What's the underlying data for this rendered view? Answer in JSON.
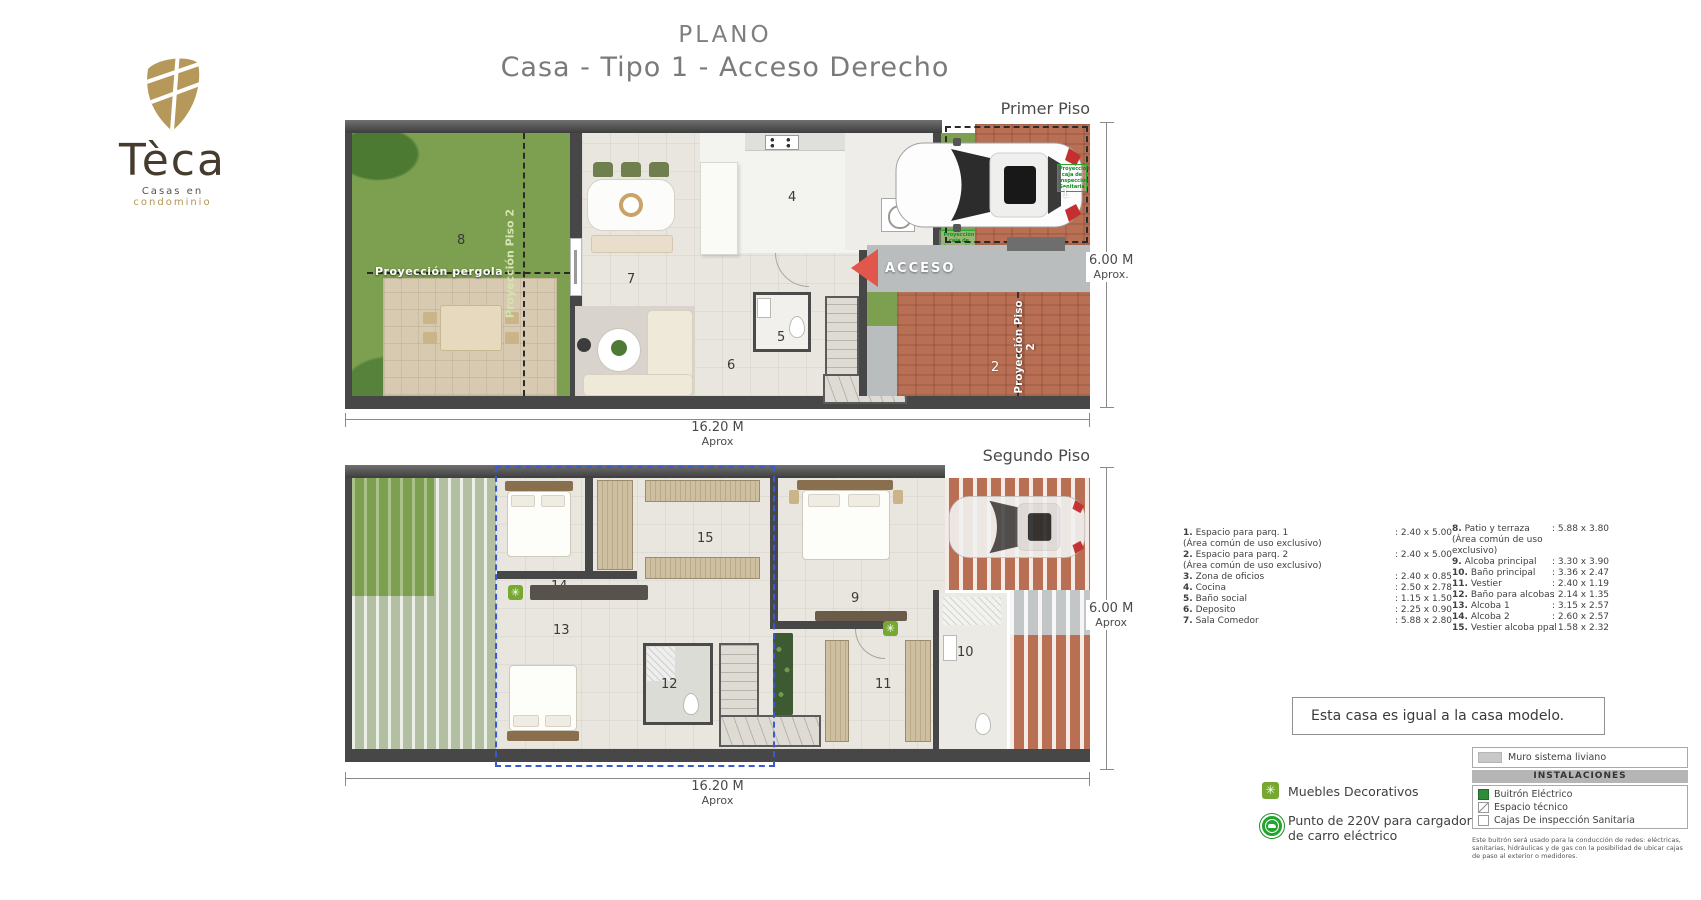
{
  "logo": {
    "brand": "Tèca",
    "tagline_a": "Casas en",
    "tagline_b": "condominio"
  },
  "title": {
    "line1": "PLANO",
    "line2": "Casa - Tipo 1 - Acceso Derecho"
  },
  "icons": {
    "asterisk": "✳"
  },
  "floor1": {
    "label": "Primer Piso",
    "dim_width": "16.20 M",
    "dim_width_sub": "Aprox",
    "dim_height": "6.00 M",
    "dim_height_sub": "Aprox.",
    "acceso": "ACCESO",
    "proy_pergola": "Proyección pergola",
    "proy_piso2_left": "Proyección Piso 2",
    "proy_piso2_right": "Proyección Piso 2",
    "proy_caja": "Proyección caja de inspección Sanitaria",
    "n1": "1",
    "n2": "2",
    "n3": "3",
    "n4": "4",
    "n5": "5",
    "n6": "6",
    "n7": "7",
    "n8": "8"
  },
  "floor2": {
    "label": "Segundo Piso",
    "dim_width": "16.20 M",
    "dim_width_sub": "Aprox",
    "dim_height": "6.00 M",
    "dim_height_sub": "Aprox",
    "n9": "9",
    "n10": "10",
    "n11": "11",
    "n12": "12",
    "n13": "13",
    "n14": "14",
    "n15": "15"
  },
  "legend": {
    "col1": [
      {
        "num": "1.",
        "name": "Espacio para parq. 1",
        "sub": "(Área común de uso exclusivo)",
        "size": ": 2.40 x 5.00"
      },
      {
        "num": "2.",
        "name": "Espacio para parq. 2",
        "sub": "(Área común de uso exclusivo)",
        "size": ": 2.40 x 5.00"
      },
      {
        "num": "3.",
        "name": "Zona de oficios",
        "size": ": 2.40 x 0.85"
      },
      {
        "num": "4.",
        "name": "Cocina",
        "size": ": 2.50 x 2.78"
      },
      {
        "num": "5.",
        "name": "Baño social",
        "size": ": 1.15 x 1.50"
      },
      {
        "num": "6.",
        "name": "Deposito",
        "size": ": 2.25 x 0.90"
      },
      {
        "num": "7.",
        "name": "Sala Comedor",
        "size": ": 5.88 x 2.80"
      }
    ],
    "col2": [
      {
        "num": "8.",
        "name": "Patio y terraza",
        "sub1": "(Área común de uso",
        "sub2": "exclusivo)",
        "size": ": 5.88 x 3.80"
      },
      {
        "num": "9.",
        "name": "Alcoba principal",
        "size": ": 3.30 x 3.90"
      },
      {
        "num": "10.",
        "name": "Baño principal",
        "size": ": 3.36 x 2.47"
      },
      {
        "num": "11.",
        "name": "Vestier",
        "size": ": 2.40 x 1.19"
      },
      {
        "num": "12.",
        "name": "Baño para alcobas",
        "size": ": 2.14 x 1.35"
      },
      {
        "num": "13.",
        "name": "Alcoba 1",
        "size": ": 3.15 x 2.57"
      },
      {
        "num": "14.",
        "name": "Alcoba 2",
        "size": ": 2.60 x 2.57"
      },
      {
        "num": "15.",
        "name": "Vestier alcoba ppal",
        "size": ": 1.58 x 2.32"
      }
    ]
  },
  "note_box": {
    "text": "Esta casa es igual a la casa modelo."
  },
  "symbols": {
    "muebles_label": "Muebles Decorativos",
    "punto_label_1": "Punto de 220V para cargador",
    "punto_label_2": "de carro eléctrico"
  },
  "install": {
    "muro": "Muro sistema liviano",
    "header": "INSTALACIONES",
    "item1": "Buitrón Eléctrico",
    "item2": "Espacio técnico",
    "item3": "Cajas De inspección Sanitaria",
    "footnote": "Este buitrón será usado para la conducción de redes: eléctricas, sanitarias, hidráulicas y de gas con la posibilidad de ubicar cajas de paso al exterior o medidores."
  },
  "colors": {
    "accent_gold": "#b2954f",
    "brand_brown": "#453b2e",
    "icon_green": "#22a52e",
    "accent_red": "#e2574c",
    "selection_blue": "#3a5bd0",
    "grass_green": "#7ca04f",
    "brick": "#b96f54"
  }
}
